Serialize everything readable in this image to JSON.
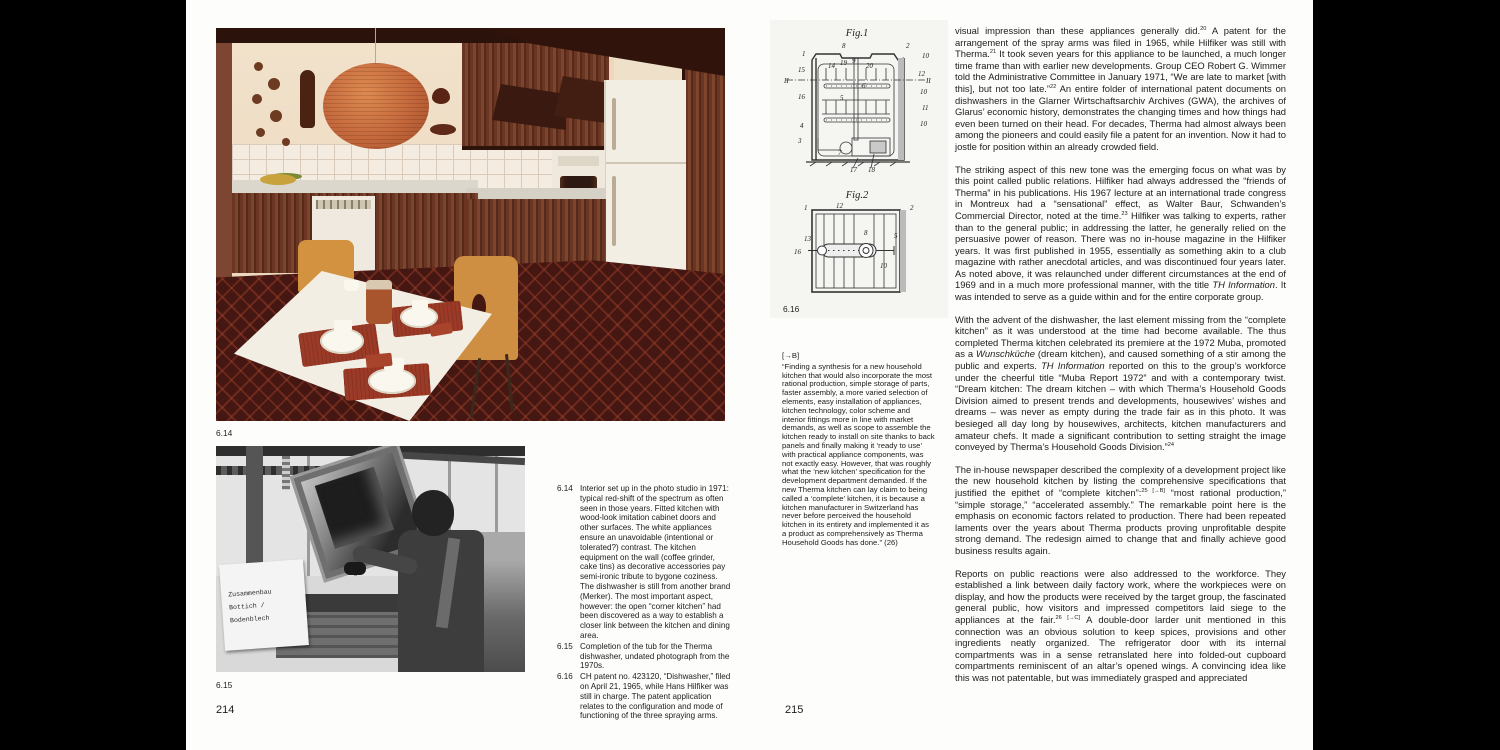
{
  "colors": {
    "lantern": "#c4683c",
    "wood": "#6a3522",
    "carpet": "#451712",
    "mat": "#9c3a28",
    "chair": "#d2923f"
  },
  "page_left": {
    "page_number": "214",
    "photo_label_kitchen": "6.14",
    "photo_label_workshop": "6.15",
    "workshop_sign": {
      "line1": "Zusammenbau",
      "line2": "Bottich / Bodenblech"
    },
    "captions": [
      {
        "num": "6.14",
        "text": "Interior set up in the photo studio in 1971: typical red-shift of the spectrum as often seen in those years. Fitted kitchen with wood-look imitation cabinet doors and other surfaces. The white appliances ensure an unavoidable (intentional or tolerated?) contrast. The kitchen equipment on the wall (coffee grinder, cake tins) as decorative accessories pay semi-ironic tribute to bygone coziness. The dishwasher is still from another brand (Merker). The most important aspect, however: the open “corner kitchen” had been discovered as a way to establish a closer link between the kitchen and dining area."
      },
      {
        "num": "6.15",
        "text": "Completion of the tub for the Therma dishwasher, undated photograph from the 1970s."
      },
      {
        "num": "6.16",
        "text": "CH patent no. 423120, “Dishwasher,” filed on April 21, 1965, while Hans Hilfiker was still in charge. The patent application relates to the configuration and mode of functioning of the three spraying arms."
      }
    ]
  },
  "page_right": {
    "page_number": "215",
    "patent": {
      "fig1_title": "Fig.1",
      "fig2_title": "Fig.2",
      "figure_label": "6.16",
      "fig1_labels": [
        {
          "t": "1",
          "x": 20,
          "y": 14
        },
        {
          "t": "8",
          "x": 60,
          "y": 6
        },
        {
          "t": "2",
          "x": 124,
          "y": 6
        },
        {
          "t": "10",
          "x": 140,
          "y": 16
        },
        {
          "t": "15",
          "x": 16,
          "y": 30
        },
        {
          "t": "14",
          "x": 46,
          "y": 26
        },
        {
          "t": "19",
          "x": 58,
          "y": 23
        },
        {
          "t": "9",
          "x": 70,
          "y": 21
        },
        {
          "t": "20",
          "x": 84,
          "y": 26
        },
        {
          "t": "6",
          "x": 80,
          "y": 46
        },
        {
          "t": "12",
          "x": 136,
          "y": 34
        },
        {
          "t": "II",
          "x": 2,
          "y": 41
        },
        {
          "t": "II",
          "x": 144,
          "y": 41
        },
        {
          "t": "16",
          "x": 16,
          "y": 57
        },
        {
          "t": "5",
          "x": 58,
          "y": 58
        },
        {
          "t": "10",
          "x": 138,
          "y": 52
        },
        {
          "t": "11",
          "x": 140,
          "y": 68
        },
        {
          "t": "4",
          "x": 18,
          "y": 86
        },
        {
          "t": "10",
          "x": 138,
          "y": 84
        },
        {
          "t": "3",
          "x": 16,
          "y": 101
        },
        {
          "t": "7",
          "x": 56,
          "y": 113
        },
        {
          "t": "17",
          "x": 68,
          "y": 130
        },
        {
          "t": "18",
          "x": 86,
          "y": 130
        }
      ],
      "fig2_labels": [
        {
          "t": "1",
          "x": 22,
          "y": 6
        },
        {
          "t": "12",
          "x": 54,
          "y": 4
        },
        {
          "t": "2",
          "x": 128,
          "y": 6
        },
        {
          "t": "13",
          "x": 22,
          "y": 37
        },
        {
          "t": "8",
          "x": 82,
          "y": 31
        },
        {
          "t": "5",
          "x": 112,
          "y": 34
        },
        {
          "t": "16",
          "x": 12,
          "y": 50
        },
        {
          "t": "10",
          "x": 98,
          "y": 64
        }
      ]
    },
    "caption_b": {
      "marker": "[→B]",
      "text": "“Finding a synthesis for a new household kitchen that would also incorporate the most rational production, simple storage of parts, faster assembly, a more varied selection of elements, easy installation of appliances, kitchen technology, color scheme and interior fittings more in line with market demands, as well as scope to assemble the kitchen ready to install on site thanks to back panels and finally making it ‘ready to use’ with practical appliance components, was not exactly easy. However, that was roughly what the ‘new kitchen’ specification for the development department demanded. If the new Therma kitchen can lay claim to being called a ‘complete’ kitchen, it is because a kitchen manufacturer in Switzerland has never before perceived the household kitchen in its entirety and implemented it as a product as comprehensively as Therma Household Goods has done.” (26)"
    },
    "body_paragraphs": [
      [
        {
          "t": "visual impression than these appliances generally did."
        },
        {
          "t": "20",
          "sup": true
        },
        {
          "t": " A patent for the arrangement of the spray arms was filed in 1965, while Hilfiker was still with Therma."
        },
        {
          "t": "21",
          "sup": true
        },
        {
          "t": " It took seven years for this appliance to be launched, a much longer time frame than with earlier new developments. Group CEO Robert G. Wimmer told the Administrative Committee in January 1971, “We are late to market [with this], but not too late.”"
        },
        {
          "t": "22",
          "sup": true
        },
        {
          "t": " An entire folder of international patent documents on dishwashers in the Glarner Wirtschaftsarchiv Archives (GWA), the archives of Glarus’ economic history, demonstrates the changing times and how things had even been turned on their head. For decades, Therma had almost always been among the pioneers and could easily file a patent for an invention. Now it had to jostle for position within an already crowded field."
        }
      ],
      [
        {
          "t": "The striking aspect of this new tone was the emerging focus on what was by this point called public relations. Hilfiker had always addressed the “friends of Therma” in his publications. His 1967 lecture at an international trade congress in Montreux had a “sensational” effect, as Walter Baur, Schwanden’s Commercial Director, noted at the time."
        },
        {
          "t": "23",
          "sup": true
        },
        {
          "t": " Hilfiker was talking to experts, rather than to the general public; in addressing the latter, he generally relied on the persuasive power of reason. There was no in-house magazine in the Hilfiker years. It was first published in 1955, essentially as something akin to a club magazine with rather anecdotal articles, and was discontinued four years later. As noted above, it was relaunched under different circumstances at the end of 1969 and in a much more professional manner, with the title "
        },
        {
          "t": "TH Information",
          "i": true
        },
        {
          "t": ". It was intended to serve as a guide within and for the entire corporate group."
        }
      ],
      [
        {
          "t": "With the advent of the dishwasher, the last element missing from the “complete kitchen” as it was understood at the time had become available. The thus completed Therma kitchen celebrated its premiere at the 1972 Muba, promoted as a "
        },
        {
          "t": "Wunschküche",
          "i": true
        },
        {
          "t": " (dream kitchen), and caused something of a stir among the public and experts. "
        },
        {
          "t": "TH Information",
          "i": true
        },
        {
          "t": " reported on this to the group’s workforce under the cheerful title “Muba Report 1972” and with a contemporary twist. “Dream kitchen: The dream kitchen – with which Therma’s Household Goods Division aimed to present trends and developments, housewives’ wishes and dreams – was never as empty during the trade fair as in this photo. It was besieged all day long by housewives, architects, kitchen manufacturers and amateur chefs. It made a significant contribution to setting straight the image conveyed by Therma’s Household Goods Division.”"
        },
        {
          "t": "24",
          "sup": true
        }
      ],
      [
        {
          "t": "The in-house newspaper described the complexity of a development project like the new household kitchen by listing the comprehensive specifications that justified the epithet of “complete kitchen”:"
        },
        {
          "t": "25 [→B]",
          "sup": true
        },
        {
          "t": " “most rational production,” “simple storage,” “accelerated assembly.” The remarkable point here is the emphasis on economic factors related to production. There had been repeated laments over the years about Therma products proving unprofitable despite strong demand. The redesign aimed to change that and finally achieve good business results again."
        }
      ],
      [
        {
          "t": "Reports on public reactions were also addressed to the workforce. They established a link between daily factory work, where the workpieces were on display, and how the products were received by the target group, the fascinated general public, how visitors and impressed competitors laid siege to the appliances at the fair."
        },
        {
          "t": "26 [→C]",
          "sup": true
        },
        {
          "t": " A double-door larder unit mentioned in this connection was an obvious solution to keep spices, provisions and other ingredients neatly organized. The refrigerator door with its internal compartments was in a sense retranslated here into folded-out cupboard compartments reminiscent of an altar’s opened wings. A convincing idea like this was not patentable, but was immediately grasped and appreciated"
        }
      ]
    ]
  }
}
